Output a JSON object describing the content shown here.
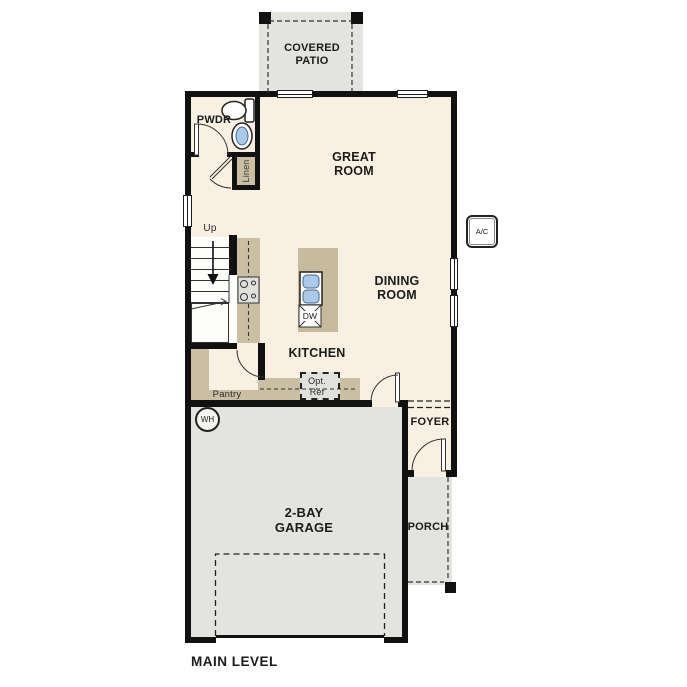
{
  "plan_title": "MAIN LEVEL",
  "colors": {
    "wall": "#111111",
    "interior_floor": "#f8f0e2",
    "exterior_concrete": "#e3e3e0",
    "counter_tan": "#cbbfa3",
    "sink_blue": "#a9cbe9"
  },
  "rooms": {
    "covered_patio": {
      "line1": "COVERED",
      "line2": "PATIO"
    },
    "great_room": {
      "line1": "GREAT",
      "line2": "ROOM"
    },
    "dining_room": {
      "line1": "DINING",
      "line2": "ROOM"
    },
    "kitchen": {
      "label": "KITCHEN"
    },
    "powder_room": {
      "label": "PWDR"
    },
    "pantry": {
      "label": "Pantry"
    },
    "foyer": {
      "label": "FOYER"
    },
    "porch": {
      "label": "PORCH"
    },
    "garage": {
      "line1": "2-BAY",
      "line2": "GARAGE"
    }
  },
  "fixtures": {
    "linen_closet": "Linen",
    "stair_direction": "Up",
    "optional_refrigerator": {
      "line1": "Opt.",
      "line2": "Ref"
    },
    "dishwasher": "DW",
    "water_heater": "WH",
    "ac_unit": "A/C"
  }
}
